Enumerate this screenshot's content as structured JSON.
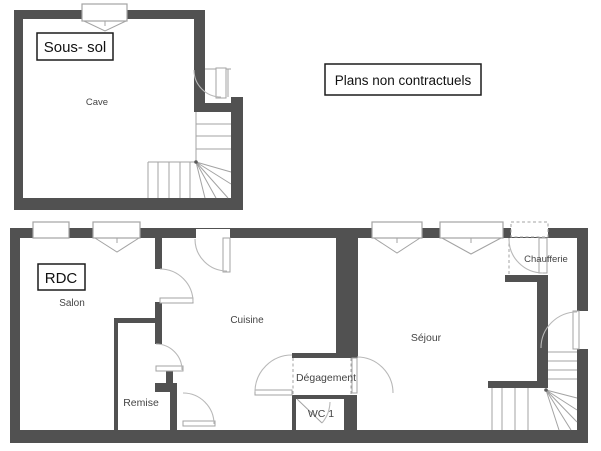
{
  "note_box": {
    "label": "Plans non contractuels"
  },
  "basement": {
    "title": "Sous- sol",
    "rooms": {
      "cave": {
        "label": "Cave"
      }
    }
  },
  "ground": {
    "title": "RDC",
    "rooms": {
      "salon": {
        "label": "Salon"
      },
      "cuisine": {
        "label": "Cuisine"
      },
      "sejour": {
        "label": "Séjour"
      },
      "remise": {
        "label": "Remise"
      },
      "degagement": {
        "label": "Dégagement"
      },
      "wc": {
        "label": "WC 1"
      },
      "chaufferie": {
        "label": "Chaufferie"
      }
    }
  },
  "colors": {
    "wall": "#515151",
    "line": "#a3a3a3",
    "arc": "#b8b8b8",
    "room_text": "#444444",
    "box_text": "#111111",
    "box_border": "#1c1c1c",
    "background": "#ffffff"
  }
}
